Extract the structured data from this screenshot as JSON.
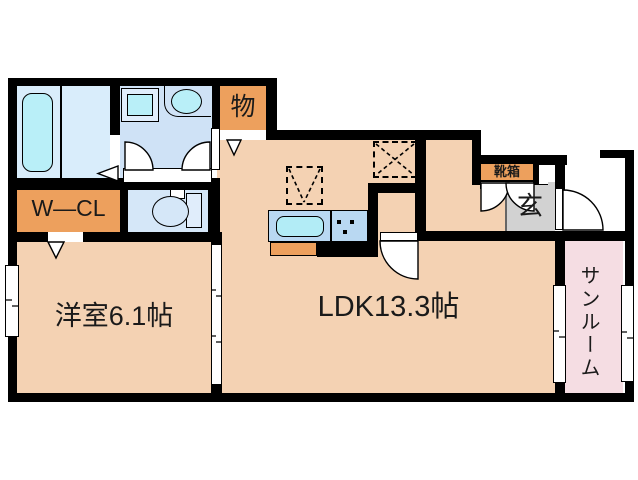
{
  "rooms": {
    "western": {
      "label": "洋室6.1帖"
    },
    "ldk": {
      "label": "LDK13.3帖"
    },
    "wcl": {
      "label": "W—CL"
    },
    "storage": {
      "label": "物"
    },
    "shoebox": {
      "label": "靴箱"
    },
    "entrance": {
      "label": "玄"
    },
    "sunroom": {
      "label": "サンルーム"
    }
  },
  "colors": {
    "wall": "#000000",
    "text": "#1a1a1a",
    "floor_main": "#f4d2b3",
    "floor_orange": "#eda05d",
    "floor_bath": "#d9edfb",
    "floor_wash": "#cfe2f6",
    "floor_toilet": "#d5e7f8",
    "floor_genkan": "#d2d2d2",
    "floor_sunroom": "#f5dde3",
    "tub": "#b9eff8",
    "counter": "#b9d8f2",
    "sink": "#b2ecf6",
    "fixture": "#e0edfb"
  }
}
